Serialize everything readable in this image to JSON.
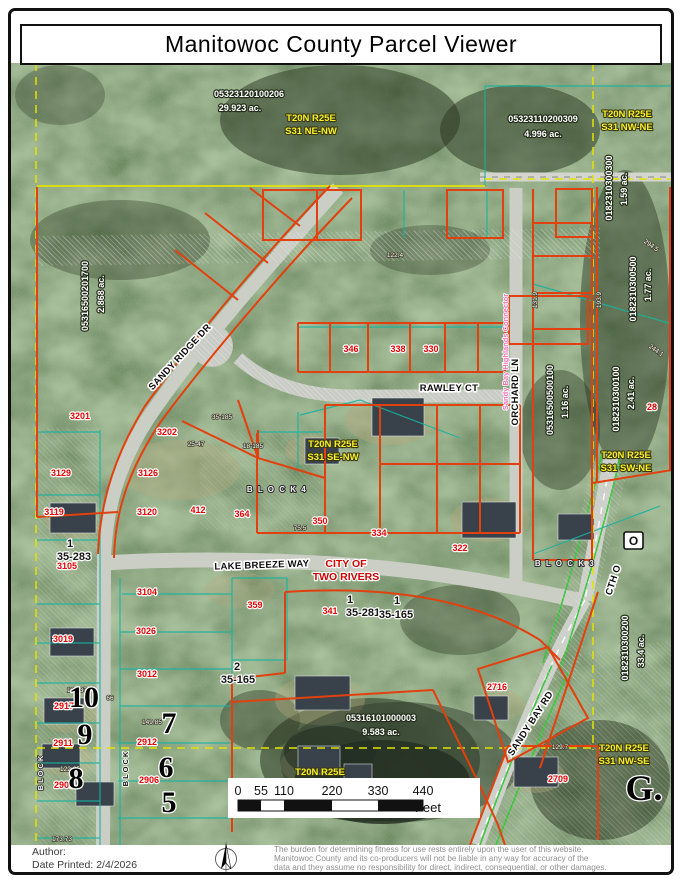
{
  "window": {
    "title": "Manitowoc County Parcel Viewer"
  },
  "footer": {
    "author_label": "Author:",
    "date_printed": "Date Printed: 2/4/2026",
    "disclaimer_lines": [
      "The burden for determining fitness for use rests entirely upon the user of this website.",
      "Manitowoc County and its co-producers will not be liable in any way for accuracy of the",
      "data and they assume no responsibility for direct, indirect, consequential, or other damages."
    ]
  },
  "map": {
    "colors": {
      "parcel_line": "#e2400e",
      "section_line": "#e3e300",
      "lot_line_teal": "#18b2a0",
      "road_green_edge": "#3bc43b",
      "plss_text": "#f7ef2a",
      "address_text": "#e60000",
      "connector_pink": "#f06eb4"
    },
    "labels": {
      "highway_shield": {
        "t": "O"
      },
      "parcel_ids": [
        {
          "t": "05323120100206",
          "x": 249,
          "y": 97
        },
        {
          "t": "29.923 ac.",
          "x": 240,
          "y": 111
        },
        {
          "t": "05323110200309",
          "x": 543,
          "y": 122
        },
        {
          "t": "4.996 ac.",
          "x": 543,
          "y": 137
        },
        {
          "t": "05316101000003",
          "x": 381,
          "y": 721
        },
        {
          "t": "9.583 ac.",
          "x": 381,
          "y": 735
        },
        {
          "t": "05316500201700",
          "x": 88,
          "y": 296,
          "r": -90
        },
        {
          "t": "2.868 ac.",
          "x": 104,
          "y": 294,
          "r": -90
        },
        {
          "t": "0182310300300",
          "x": 612,
          "y": 188,
          "r": -90
        },
        {
          "t": "1.59 ac.",
          "x": 627,
          "y": 189,
          "r": -90
        },
        {
          "t": "0182310300500",
          "x": 636,
          "y": 289,
          "r": -90
        },
        {
          "t": "1.77 ac.",
          "x": 651,
          "y": 285,
          "r": -90
        },
        {
          "t": "0182310300100",
          "x": 619,
          "y": 399,
          "r": -90
        },
        {
          "t": "2.41 ac.",
          "x": 634,
          "y": 393,
          "r": -90
        },
        {
          "t": "05316500500100",
          "x": 553,
          "y": 400,
          "r": -90
        },
        {
          "t": "1.16 ac.",
          "x": 568,
          "y": 402,
          "r": -90
        },
        {
          "t": "0182310300200",
          "x": 628,
          "y": 648,
          "r": -90
        },
        {
          "t": "33.4 ac.",
          "x": 644,
          "y": 651,
          "r": -90
        }
      ],
      "plss": [
        {
          "t": "T20N R25E",
          "x": 311,
          "y": 121
        },
        {
          "t": "S31 NE-NW",
          "x": 311,
          "y": 134
        },
        {
          "t": "T20N R25E",
          "x": 627,
          "y": 117
        },
        {
          "t": "S31 NW-NE",
          "x": 627,
          "y": 130
        },
        {
          "t": "T20N R25E",
          "x": 333,
          "y": 447
        },
        {
          "t": "S31 SE-NW",
          "x": 333,
          "y": 460
        },
        {
          "t": "T20N R25E",
          "x": 626,
          "y": 458
        },
        {
          "t": "S31 SW-NE",
          "x": 626,
          "y": 471
        },
        {
          "t": "T20N R25E",
          "x": 624,
          "y": 751
        },
        {
          "t": "S31 NW-SE",
          "x": 624,
          "y": 764
        },
        {
          "t": "T20N R25E",
          "x": 320,
          "y": 775
        }
      ],
      "addresses": [
        {
          "t": "3201",
          "x": 80,
          "y": 419
        },
        {
          "t": "3202",
          "x": 167,
          "y": 435
        },
        {
          "t": "3129",
          "x": 61,
          "y": 476
        },
        {
          "t": "3126",
          "x": 148,
          "y": 476
        },
        {
          "t": "3119",
          "x": 54,
          "y": 515
        },
        {
          "t": "3120",
          "x": 147,
          "y": 515
        },
        {
          "t": "412",
          "x": 198,
          "y": 513
        },
        {
          "t": "364",
          "x": 242,
          "y": 517
        },
        {
          "t": "350",
          "x": 320,
          "y": 524
        },
        {
          "t": "334",
          "x": 379,
          "y": 536
        },
        {
          "t": "322",
          "x": 460,
          "y": 551
        },
        {
          "t": "346",
          "x": 351,
          "y": 352
        },
        {
          "t": "338",
          "x": 398,
          "y": 352
        },
        {
          "t": "330",
          "x": 431,
          "y": 352
        },
        {
          "t": "359",
          "x": 255,
          "y": 608
        },
        {
          "t": "341",
          "x": 330,
          "y": 614
        },
        {
          "t": "3105",
          "x": 67,
          "y": 569
        },
        {
          "t": "3104",
          "x": 147,
          "y": 595
        },
        {
          "t": "3026",
          "x": 146,
          "y": 634
        },
        {
          "t": "3019",
          "x": 63,
          "y": 642
        },
        {
          "t": "3012",
          "x": 147,
          "y": 677
        },
        {
          "t": "2917",
          "x": 64,
          "y": 709
        },
        {
          "t": "2911",
          "x": 63,
          "y": 746
        },
        {
          "t": "2912",
          "x": 147,
          "y": 745
        },
        {
          "t": "2905",
          "x": 64,
          "y": 788
        },
        {
          "t": "2906",
          "x": 149,
          "y": 783
        },
        {
          "t": "2716",
          "x": 497,
          "y": 690
        },
        {
          "t": "2709",
          "x": 558,
          "y": 782
        },
        {
          "t": "28",
          "x": 652,
          "y": 410
        }
      ],
      "plat": [
        {
          "t": "1",
          "x": 70,
          "y": 547
        },
        {
          "t": "35-283",
          "x": 74,
          "y": 560
        },
        {
          "t": "1",
          "x": 350,
          "y": 603
        },
        {
          "t": "35-281",
          "x": 363,
          "y": 616
        },
        {
          "t": "1",
          "x": 397,
          "y": 604
        },
        {
          "t": "35-165",
          "x": 396,
          "y": 618
        },
        {
          "t": "2",
          "x": 237,
          "y": 670
        },
        {
          "t": "35-165",
          "x": 238,
          "y": 683
        }
      ],
      "streets": [
        {
          "t": "SANDY RIDGE DR",
          "x": 182,
          "y": 359,
          "r": -47
        },
        {
          "t": "RAWLEY CT",
          "x": 449,
          "y": 391
        },
        {
          "t": "LAKE BREEZE WAY",
          "x": 262,
          "y": 568,
          "r": -2
        },
        {
          "t": "ORCHARD LN",
          "x": 518,
          "y": 392,
          "r": -90
        },
        {
          "t": "CTH O",
          "x": 616,
          "y": 581,
          "r": -72
        },
        {
          "t": "SANDY BAY RD",
          "x": 533,
          "y": 725,
          "r": -57
        }
      ],
      "city": [
        {
          "t": "CITY OF",
          "x": 346,
          "y": 567
        },
        {
          "t": "TWO RIVERS",
          "x": 346,
          "y": 580
        }
      ],
      "marks": [
        {
          "t": "B L O C K  4",
          "x": 277,
          "y": 492,
          "c": "bl"
        },
        {
          "t": "B L O C K  3",
          "x": 565,
          "y": 566,
          "c": "bl"
        },
        {
          "t": "BLOCK",
          "x": 128,
          "y": 768,
          "r": -90,
          "c": "blk"
        },
        {
          "t": "BLOCK",
          "x": 43,
          "y": 772,
          "r": -90,
          "c": "bl2"
        },
        {
          "t": "10",
          "x": 84,
          "y": 707,
          "s": 30,
          "c": "bn"
        },
        {
          "t": "9",
          "x": 85,
          "y": 744,
          "s": 30,
          "c": "bn"
        },
        {
          "t": "8",
          "x": 76,
          "y": 788,
          "s": 30,
          "c": "bn"
        },
        {
          "t": "7",
          "x": 169,
          "y": 733,
          "s": 30,
          "c": "bn"
        },
        {
          "t": "6",
          "x": 166,
          "y": 777,
          "s": 30,
          "c": "bn"
        },
        {
          "t": "5",
          "x": 169,
          "y": 812,
          "s": 30,
          "c": "bn"
        },
        {
          "t": "G.",
          "x": 644,
          "y": 800,
          "s": 36,
          "c": "bn"
        }
      ],
      "connector": [
        {
          "t": "Sandy Bay Highlands Connector",
          "x": 508,
          "y": 352,
          "r": -90
        }
      ],
      "dimensions": [
        {
          "t": "25-47",
          "x": 196,
          "y": 446
        },
        {
          "t": "18-185",
          "x": 253,
          "y": 448
        },
        {
          "t": "35-185",
          "x": 222,
          "y": 419
        },
        {
          "t": "122.4",
          "x": 395,
          "y": 257
        },
        {
          "t": "134.37",
          "x": 77,
          "y": 692
        },
        {
          "t": "149.85",
          "x": 152,
          "y": 724
        },
        {
          "t": "122.65",
          "x": 70,
          "y": 771
        },
        {
          "t": "173.73",
          "x": 62,
          "y": 841
        },
        {
          "t": "129.7",
          "x": 560,
          "y": 749
        },
        {
          "t": "131.9",
          "x": 537,
          "y": 300,
          "r": -90
        },
        {
          "t": "294.5",
          "x": 650,
          "y": 247,
          "r": 35
        },
        {
          "t": "244.1",
          "x": 655,
          "y": 352,
          "r": 35
        },
        {
          "t": "193.9",
          "x": 601,
          "y": 300,
          "r": -90
        },
        {
          "t": "66",
          "x": 110,
          "y": 700
        },
        {
          "t": "75.5",
          "x": 300,
          "y": 530
        }
      ],
      "scale": [
        {
          "t": "0",
          "x": 238,
          "y": 795
        },
        {
          "t": "55",
          "x": 261,
          "y": 795
        },
        {
          "t": "110",
          "x": 284,
          "y": 795
        },
        {
          "t": "220",
          "x": 332,
          "y": 795
        },
        {
          "t": "330",
          "x": 378,
          "y": 795
        },
        {
          "t": "440",
          "x": 423,
          "y": 795
        },
        {
          "t": "Feet",
          "x": 428,
          "y": 812,
          "a": "start",
          "s": 13
        }
      ]
    }
  }
}
